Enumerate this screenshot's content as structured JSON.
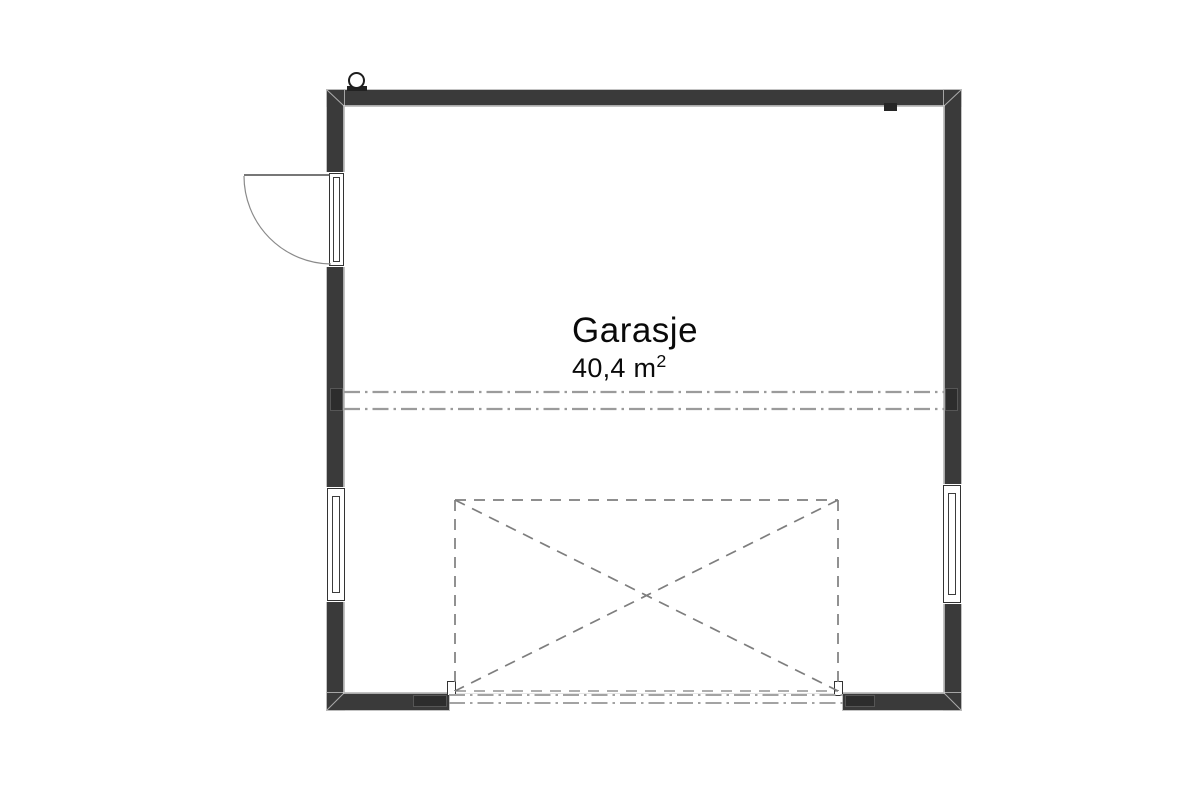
{
  "floor_plan": {
    "room": {
      "name": "Garasje",
      "area_value": "40,4 m",
      "area_superscript": "2",
      "area_full": "40,4 m²"
    },
    "colors": {
      "wall": "#3a3a3a",
      "frame_line": "#333333",
      "dashed_line": "#7e7e7e",
      "dash_dot_line": "#9b9b9b",
      "background": "#ffffff"
    },
    "symbols": [
      "door-swing-icon",
      "window-icon",
      "vent-pipe-icon",
      "garage-door-opening-marker",
      "ceiling-beam-line"
    ]
  }
}
